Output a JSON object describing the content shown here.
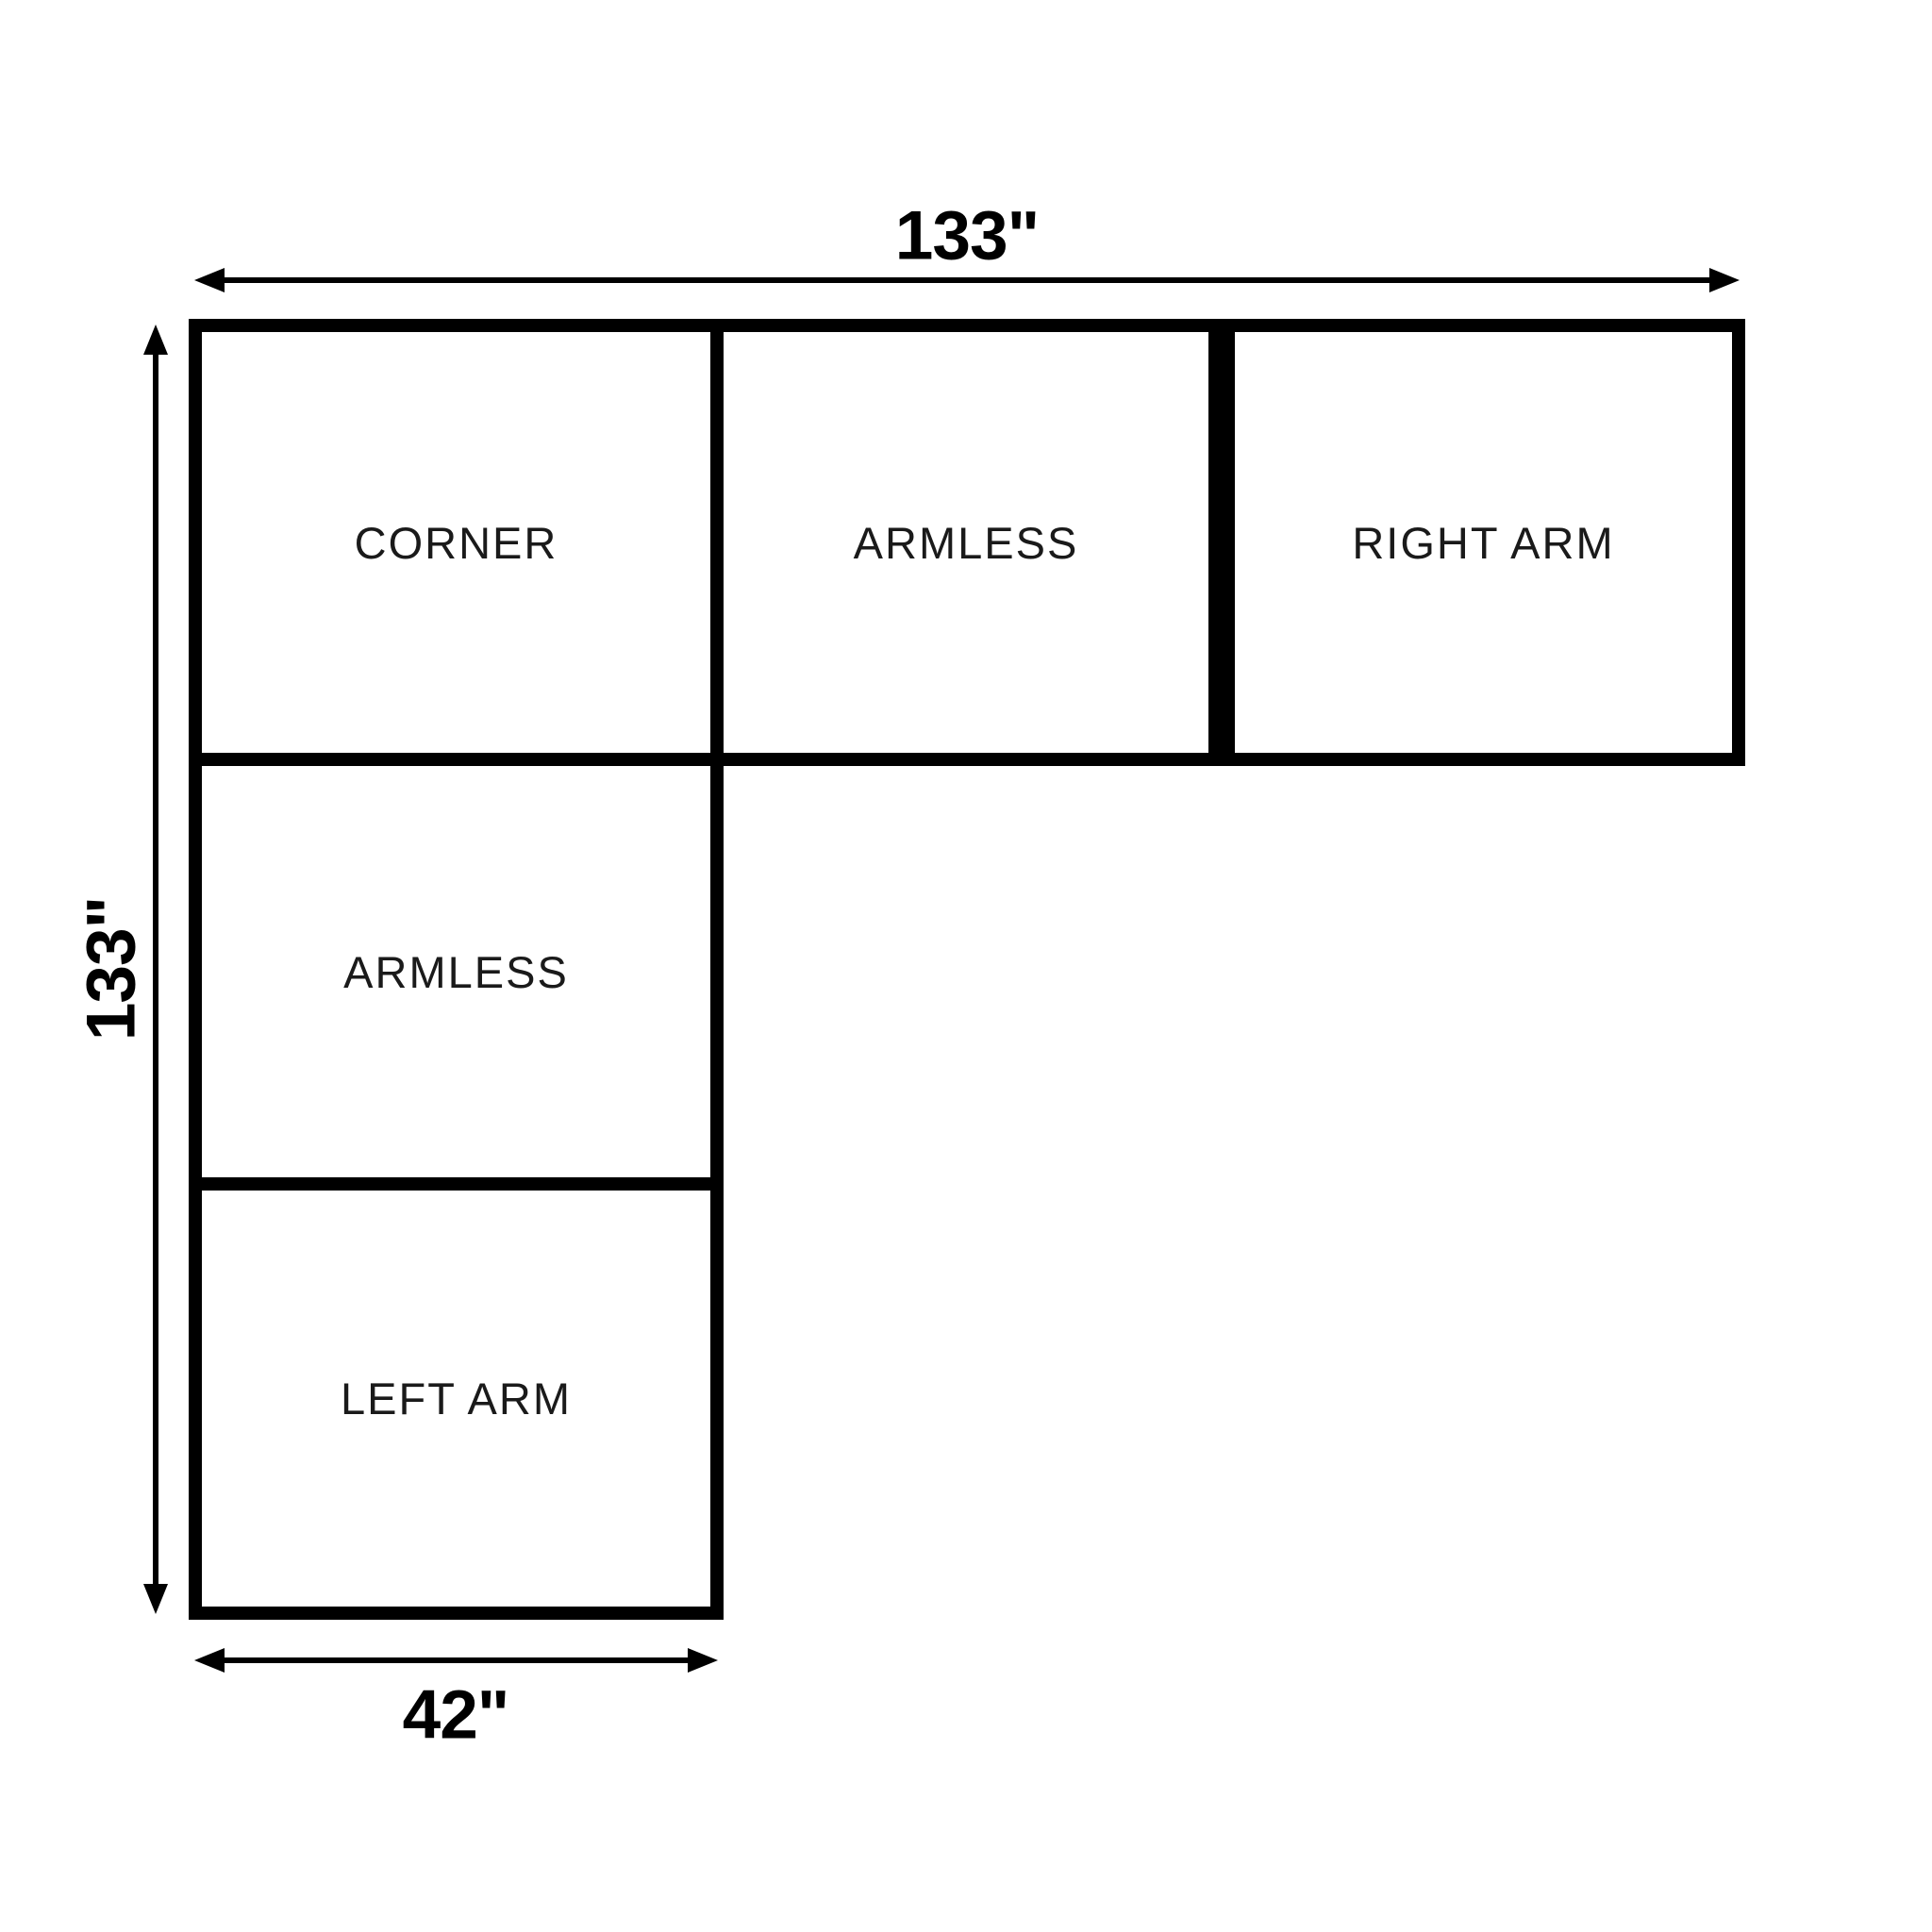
{
  "modules": [
    {
      "id": "corner",
      "label": "CORNER"
    },
    {
      "id": "armless-top",
      "label": "ARMLESS"
    },
    {
      "id": "right-arm",
      "label": "RIGHT ARM"
    },
    {
      "id": "armless-left",
      "label": "ARMLESS"
    },
    {
      "id": "left-arm",
      "label": "LEFT ARM"
    }
  ],
  "dimensions": {
    "top": "133\"",
    "left": "133\"",
    "bottom": "42\""
  },
  "icons": {
    "dimension_arrowhead": "filled-triangle"
  },
  "theme": {
    "background": "#ffffff",
    "line_color": "#000000",
    "module_text_color": "#1a1a1a",
    "dimension_text_color": "#000000"
  }
}
